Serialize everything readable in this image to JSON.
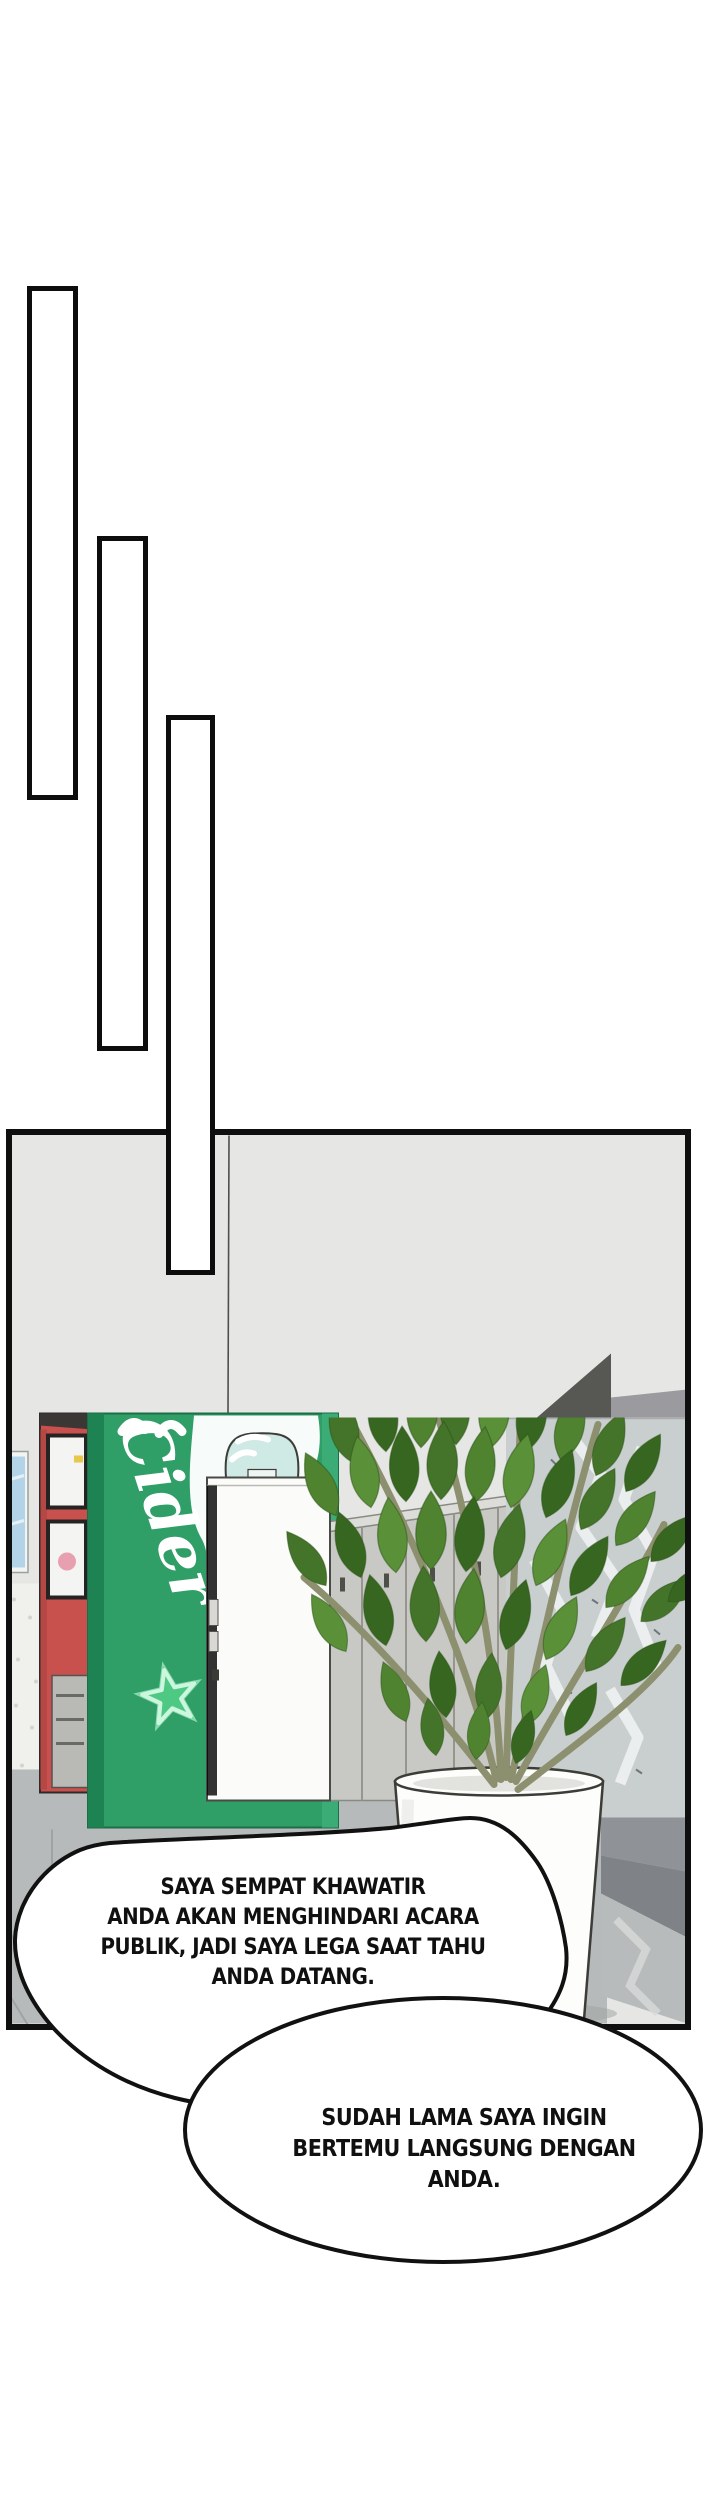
{
  "page": {
    "background_color": "#ffffff"
  },
  "panel": {
    "wall_color": "#e6e6e4",
    "border_color": "#0f0f0f",
    "scene": {
      "cider_label": "Cider",
      "colors": {
        "green_machine": "#2f9e67",
        "green_machine_side": "#1e8353",
        "red_machine": "#c8504d",
        "poster_blue": "#b3d4e8",
        "bottle_teal": "#cfe9e4",
        "cooler_white": "#fbfbf9",
        "locker_grey": "#c8c8c4",
        "marble_grey": "#c9cecf",
        "leaf_green": "#4a7c2e",
        "stem_olive": "#8c906e",
        "pot_white": "#fdfdfb",
        "floor_grey": "#b5b9b9",
        "dark_corner": "#575753"
      }
    }
  },
  "speech_bubbles": [
    {
      "lines": [
        "SAYA SEMPAT KHAWATIR",
        "ANDA AKAN MENGHINDARI ACARA",
        "PUBLIK, JADI SAYA LEGA SAAT TAHU",
        "ANDA DATANG."
      ]
    },
    {
      "lines": [
        "SUDAH LAMA SAYA INGIN",
        "BERTEMU LANGSUNG DENGAN",
        "ANDA."
      ]
    }
  ]
}
